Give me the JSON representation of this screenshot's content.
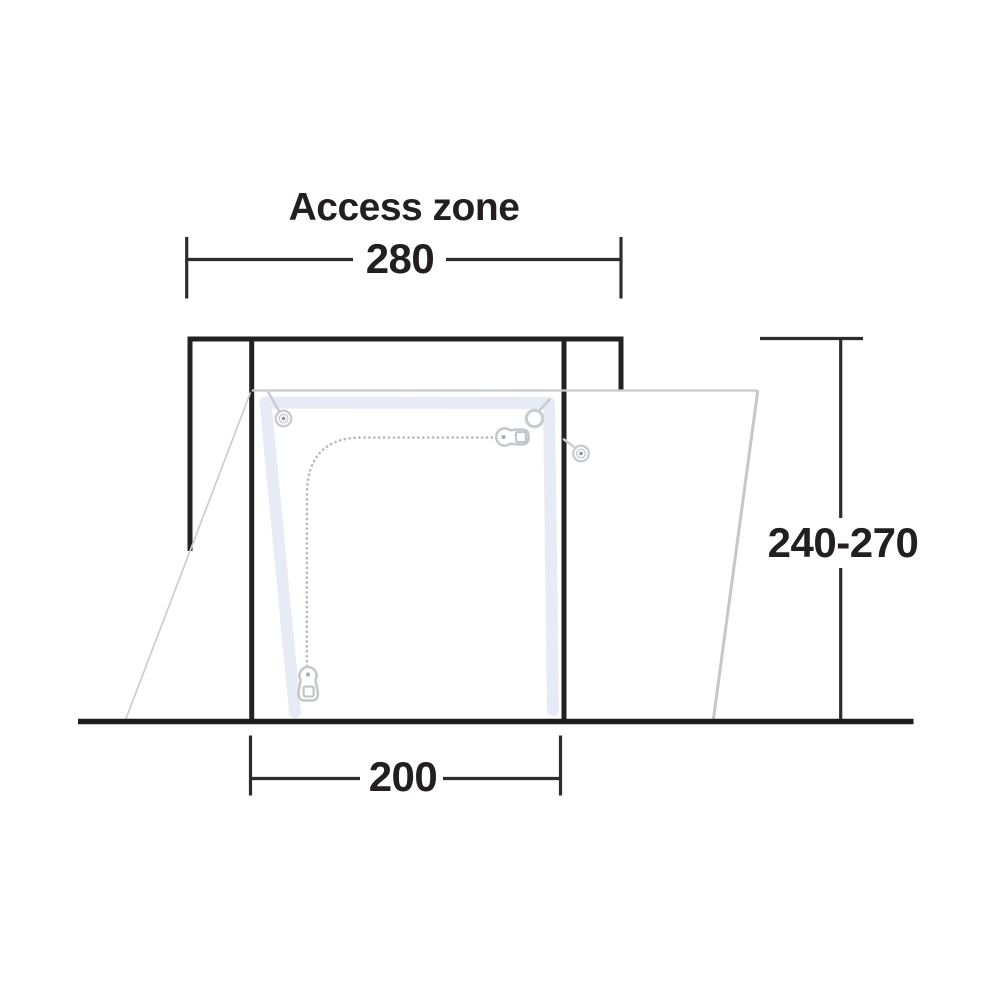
{
  "diagram": {
    "title": "Access zone",
    "access_zone_width": "280",
    "door_width": "200",
    "height_range": "240-270"
  },
  "colors": {
    "outline_black": "#222222",
    "ground_black": "#1e1e1e",
    "dimension_black": "#2d2d2d",
    "text_black": "#231f20",
    "awning_gray": "#c9cbce",
    "door_trim_blue": "#e7ebf6",
    "zipper_gray": "#b6bac0",
    "hardware_gray": "#c9cdd2",
    "hardware_dot_gray": "#8d9196",
    "background": "#ffffff"
  },
  "icons": {
    "zipper_pull_top": "zipper-pull-icon",
    "zipper_pull_bottom": "zipper-pull-icon",
    "toggle_left": "toggle-fastener-icon",
    "toggle_right": "toggle-fastener-icon",
    "ring_top_right": "ring-fastener-icon"
  }
}
